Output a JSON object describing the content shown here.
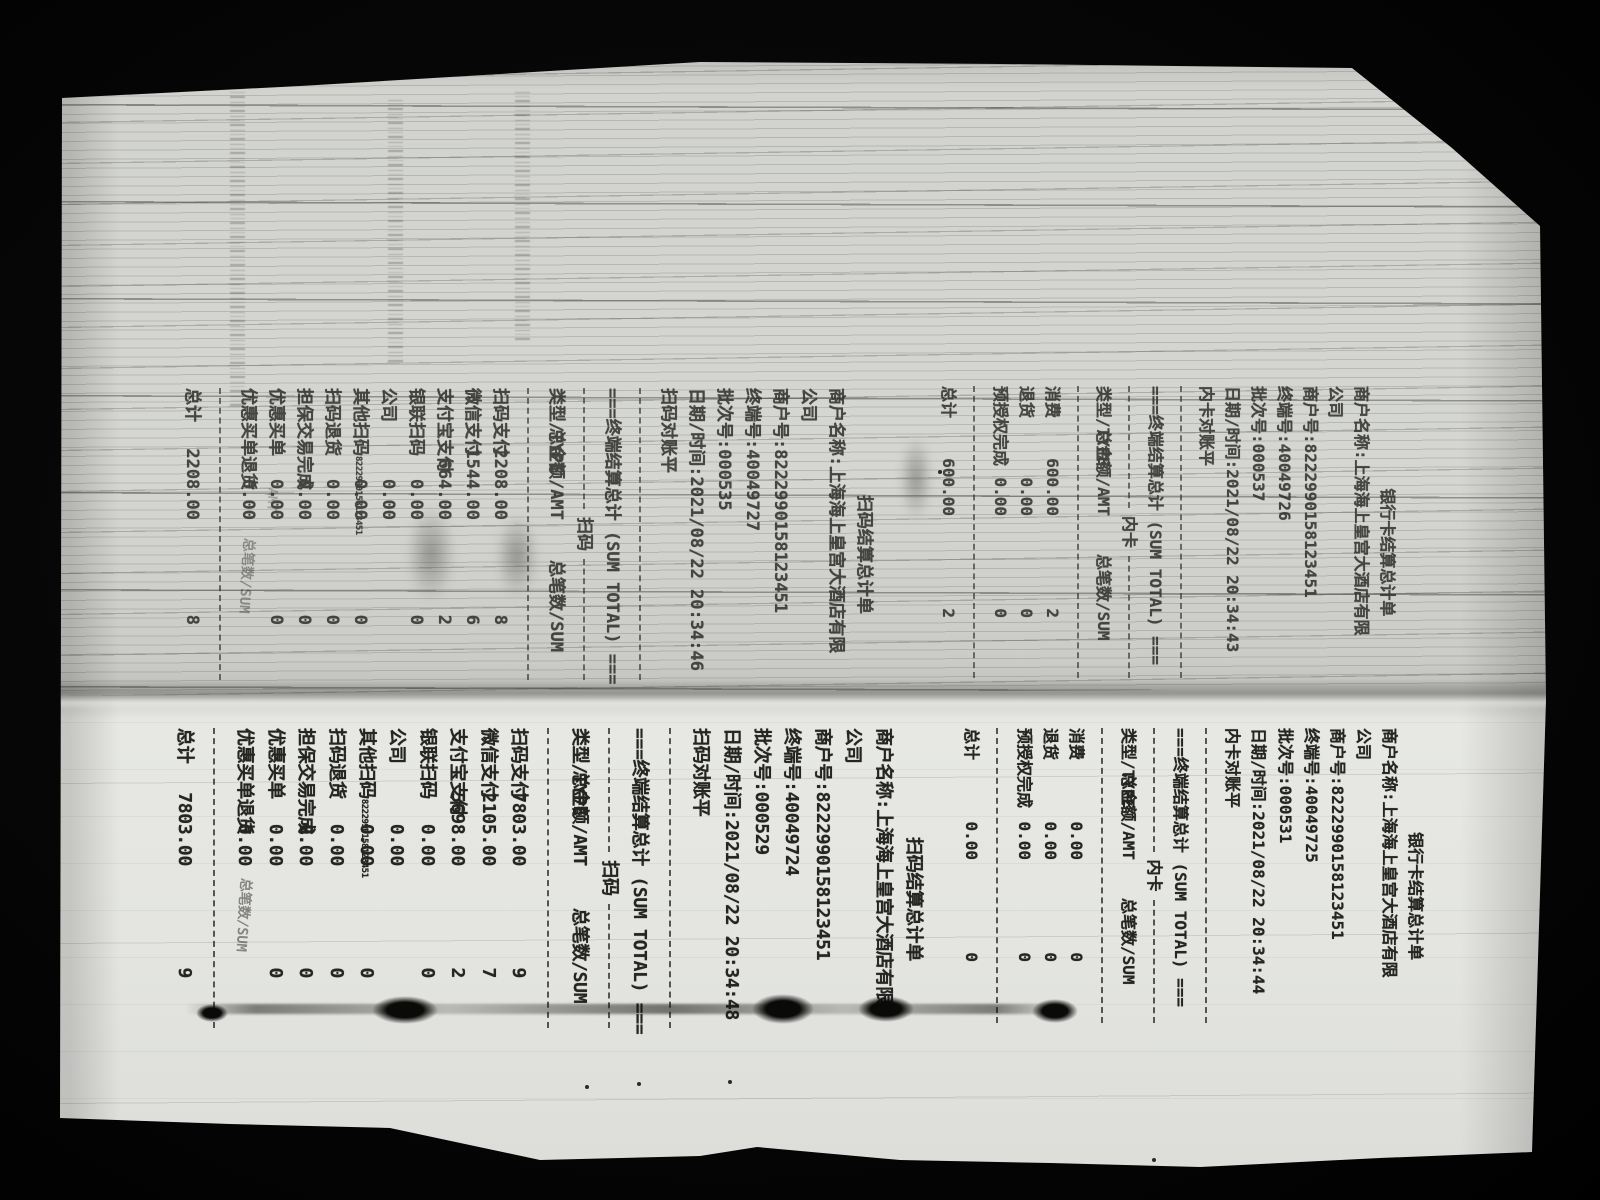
{
  "photo": {
    "background": "#080808",
    "paper_color": "#d8d9d5",
    "ink_color": "#242422"
  },
  "receipts": [
    {
      "kind": "bank-card-top",
      "title": "银行卡结算总计单",
      "header_lines": [
        "商户名称:上海海上皇宫大酒店有限",
        "公司",
        "商户号:8222990158123451",
        "终端号:40049726",
        "批次号:000537",
        "日期/时间:2021/08/22 20:34:43",
        "内卡对账平"
      ],
      "sum_total_line": "===终端结算总计 (SUM TOTAL) ===",
      "section_label": "内卡",
      "columns": {
        "type": "类型/TYPE",
        "amount": "总金额/AMT",
        "count": "总笔数/SUM"
      },
      "rows": [
        {
          "label": "消费",
          "amount": "600.00",
          "count": "2"
        },
        {
          "label": "退货",
          "amount": "0.00",
          "count": "0"
        },
        {
          "label": "预授权完成",
          "amount": "0.00",
          "count": "0"
        }
      ],
      "total": {
        "label": "总计",
        "amount": "600.00",
        "count": "2"
      },
      "ghosts": {}
    },
    {
      "kind": "scan-code-top",
      "title": "扫码结算总计单",
      "header_lines": [
        "商户名称:上海海上皇宫大酒店有限",
        "公司",
        "商户号:8222990158123451",
        "终端号:40049727",
        "批次号:000535",
        "日期/时间:2021/08/22 20:34:46",
        "扫码对账平"
      ],
      "sum_total_line": "===终端结算总计 (SUM TOTAL) ===",
      "section_label": "扫码",
      "columns": {
        "type": "类型/TYPE",
        "amount": "总金额/AMT",
        "count": "总笔数/SUM"
      },
      "rows": [
        {
          "label": "扫码支付",
          "amount": "2208.00",
          "count": "8"
        },
        {
          "label": "微信支付",
          "amount": "1544.00",
          "count": "6"
        },
        {
          "label": "支付宝支付",
          "amount": "664.00",
          "count": "2"
        },
        {
          "label": "银联扫码",
          "amount": "0.00",
          "count": "0"
        },
        {
          "label": "公司",
          "amount": "0.00",
          "count": ""
        },
        {
          "label": "其他扫码",
          "sub": "8222990158123451",
          "amount": "0.00",
          "count": "0"
        },
        {
          "label": "扫码退货",
          "amount": "0.00",
          "count": "0"
        },
        {
          "label": "担保交易完成",
          "amount": "0.00",
          "count": "0"
        },
        {
          "label": "优惠买单",
          "amount": "0.00",
          "count": "0"
        },
        {
          "label": "优惠买单退货",
          "amount": "0.00",
          "count": ""
        }
      ],
      "total": {
        "label": "总计",
        "amount": "2208.00",
        "count": "8"
      },
      "ghosts": {
        "sum": "总笔数/SUM",
        "amt": "AMT"
      }
    },
    {
      "kind": "bank-card-bottom",
      "title": "银行卡结算总计单",
      "header_lines": [
        "商户名称:上海海上皇宫大酒店有限",
        "公司",
        "商户号:8222990158123451",
        "终端号:40049725",
        "批次号:000531",
        "日期/时间:2021/08/22 20:34:44",
        "内卡对账平"
      ],
      "sum_total_line": "===终端结算总计 (SUM TOTAL) ===",
      "section_label": "内卡",
      "columns": {
        "type": "类型/TYPE",
        "amount": "总金额/AMT",
        "count": "总笔数/SUM"
      },
      "rows": [
        {
          "label": "消费",
          "amount": "0.00",
          "count": "0"
        },
        {
          "label": "退货",
          "amount": "0.00",
          "count": "0"
        },
        {
          "label": "预授权完成",
          "amount": "0.00",
          "count": "0"
        }
      ],
      "total": {
        "label": "总计",
        "amount": "0.00",
        "count": "0"
      },
      "ghosts": {}
    },
    {
      "kind": "scan-code-bottom",
      "title": "扫码结算总计单",
      "header_lines": [
        "商户名称:上海海上皇宫大酒店有限",
        "公司",
        "商户号:8222990158123451",
        "终端号:40049724",
        "批次号:000529",
        "日期/时间:2021/08/22 20:34:48",
        "扫码对账平"
      ],
      "sum_total_line": "===终端结算总计 (SUM TOTAL) ===",
      "section_label": "扫码",
      "columns": {
        "type": "类型/TYPE",
        "amount": "总金额/AMT",
        "count": "总笔数/SUM"
      },
      "rows": [
        {
          "label": "扫码支付",
          "amount": "7803.00",
          "count": "9"
        },
        {
          "label": "微信支付",
          "amount": "2105.00",
          "count": "7"
        },
        {
          "label": "支付宝支付",
          "amount": "5698.00",
          "count": "2"
        },
        {
          "label": "银联扫码",
          "amount": "0.00",
          "count": "0"
        },
        {
          "label": "公司",
          "amount": "0.00",
          "count": ""
        },
        {
          "label": "其他扫码",
          "sub": "8222990158123451",
          "amount": "0.00",
          "count": "0"
        },
        {
          "label": "扫码退货",
          "amount": "0.00",
          "count": "0"
        },
        {
          "label": "担保交易完成",
          "amount": "0.00",
          "count": "0"
        },
        {
          "label": "优惠买单",
          "amount": "0.00",
          "count": "0"
        },
        {
          "label": "优惠买单退货",
          "amount": "0.00",
          "count": ""
        }
      ],
      "total": {
        "label": "总计",
        "amount": "7803.00",
        "count": "9"
      },
      "ghosts": {
        "sum": "总笔数/SUM"
      }
    }
  ]
}
